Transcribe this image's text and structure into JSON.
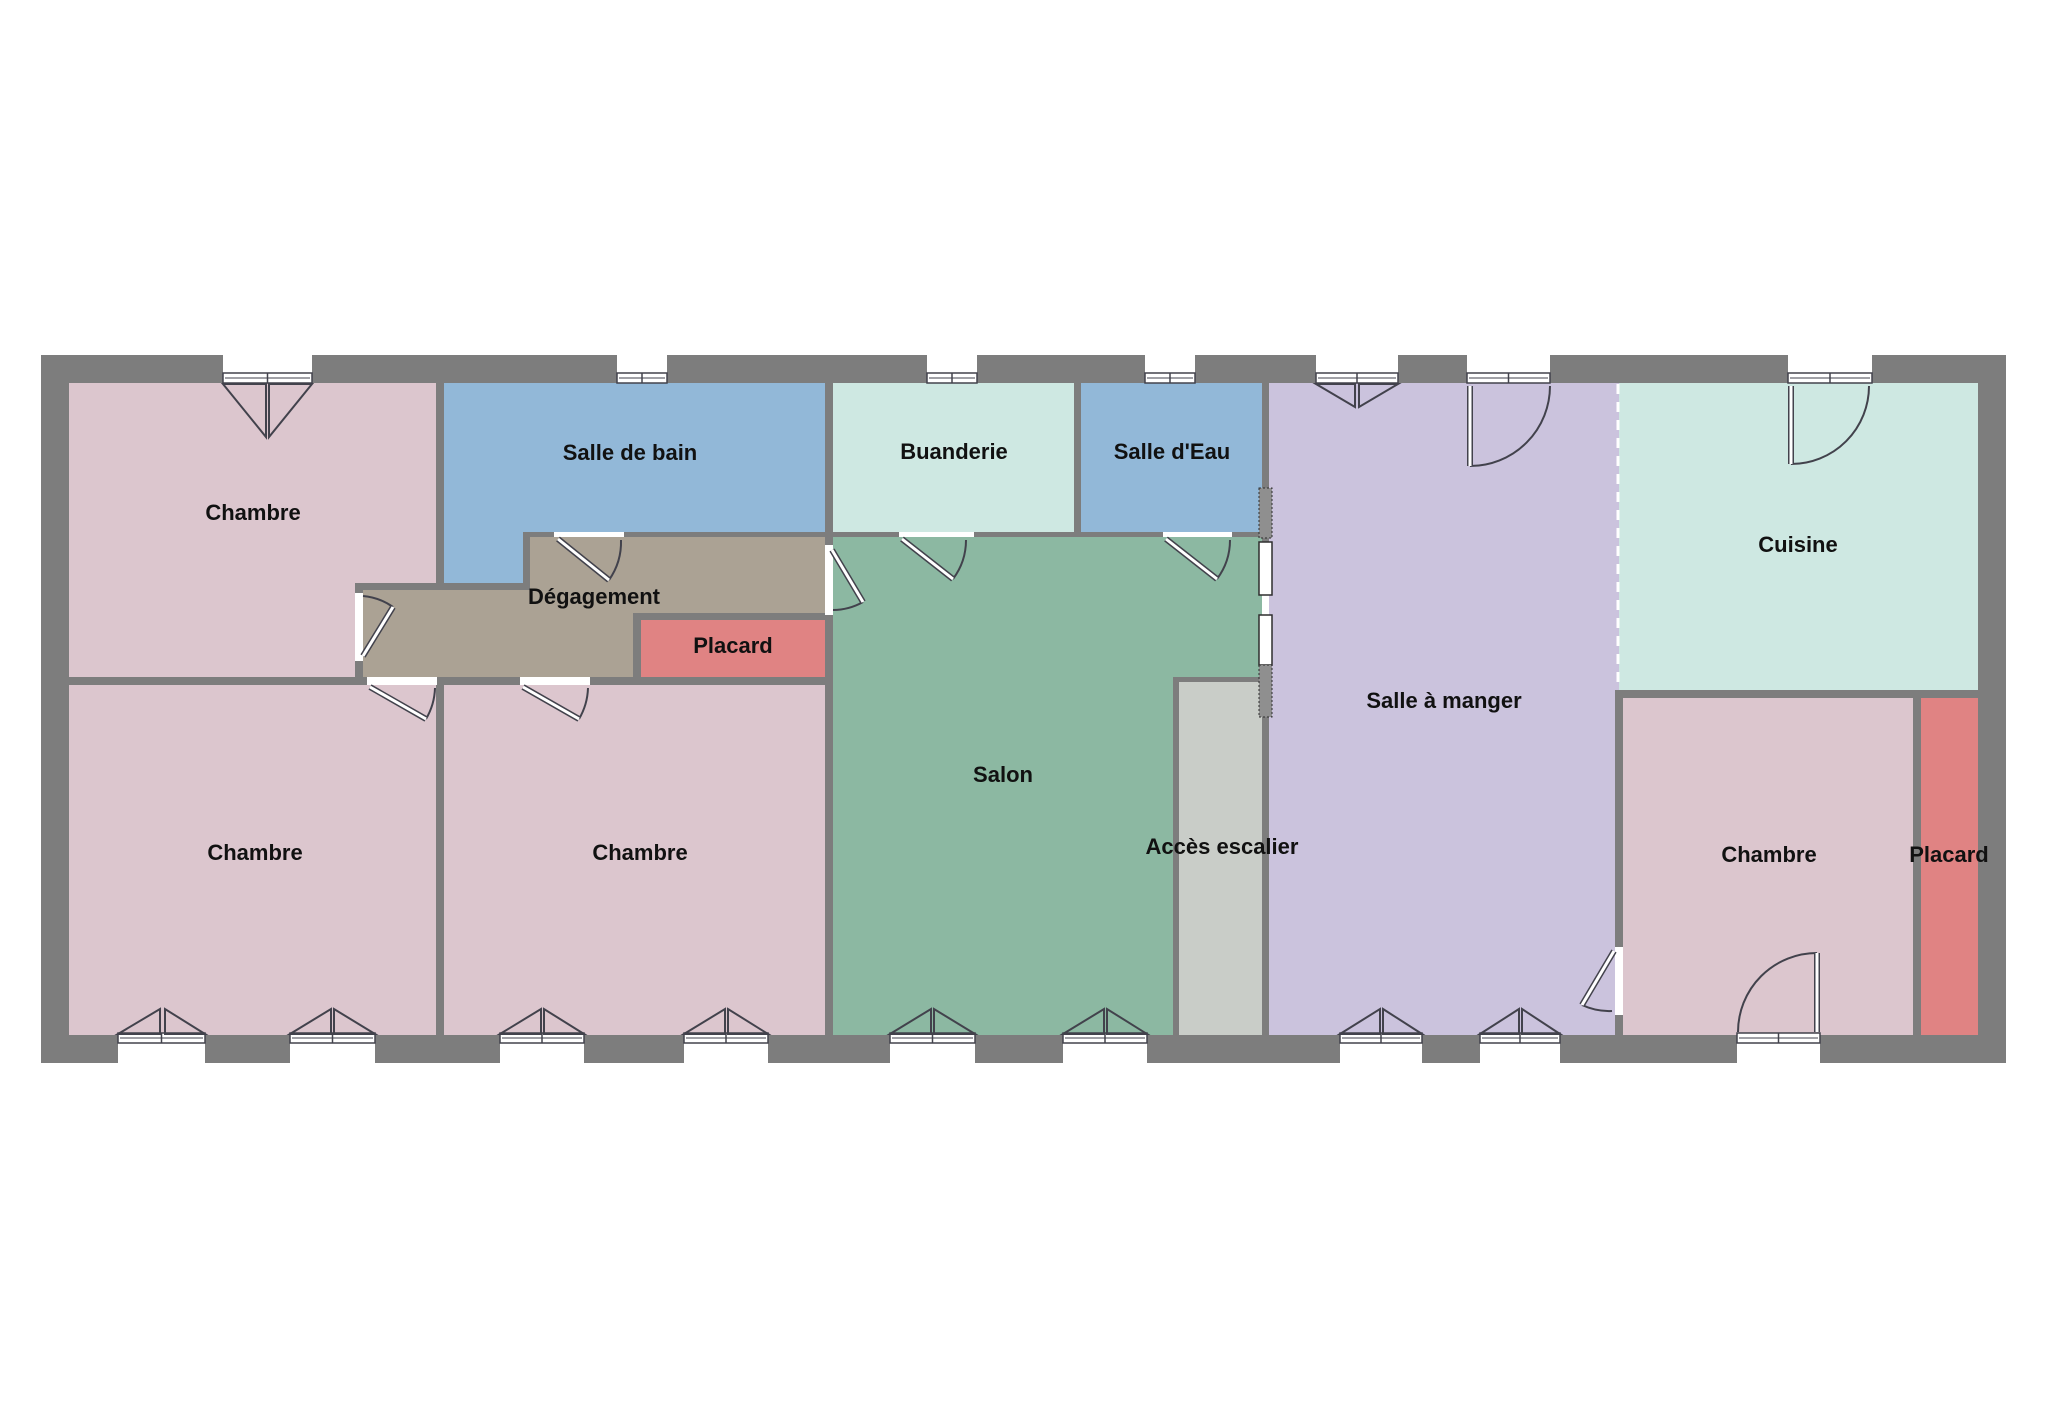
{
  "canvas": {
    "width": 2048,
    "height": 1417,
    "background": "#ffffff"
  },
  "colors": {
    "wall": "#7d7d7d",
    "line": "#42424c",
    "opening_fill": "#ffffff",
    "hatch_fill": "#8f8f8f",
    "label_color": "#111111",
    "bedroom_pink": "#dcc6ce",
    "bath_blue": "#92b8d8",
    "mint": "#cee8e2",
    "salon_green": "#8cb8a2",
    "corridor_taupe": "#aba294",
    "placard_red": "#e08383",
    "dining_purple": "#cbc3dd",
    "stair_gray": "#c9cdc8"
  },
  "shell": {
    "x": 41,
    "y": 355,
    "w": 1965,
    "h": 708
  },
  "rooms": [
    {
      "id": "chambre-tl",
      "label": "Chambre",
      "color": "#dcc6ce",
      "rects": [
        [
          69,
          383,
          367,
          200
        ],
        [
          69,
          583,
          286,
          94
        ]
      ],
      "label_pos": [
        253,
        513
      ]
    },
    {
      "id": "salle-de-bain",
      "label": "Salle de bain",
      "color": "#92b8d8",
      "rects": [
        [
          444,
          383,
          381,
          149
        ],
        [
          444,
          532,
          79,
          51
        ]
      ],
      "label_pos": [
        630,
        453
      ]
    },
    {
      "id": "buanderie",
      "label": "Buanderie",
      "color": "#cee8e2",
      "rects": [
        [
          833,
          383,
          241,
          149
        ]
      ],
      "label_pos": [
        954,
        452
      ]
    },
    {
      "id": "salle-d-eau",
      "label": "Salle d'Eau",
      "color": "#92b8d8",
      "rects": [
        [
          1081,
          383,
          181,
          149
        ]
      ],
      "label_pos": [
        1172,
        452
      ]
    },
    {
      "id": "degagement",
      "label": "Dégagement",
      "color": "#aba294",
      "rects": [
        [
          530,
          537,
          295,
          76
        ],
        [
          530,
          613,
          103,
          64
        ],
        [
          363,
          590,
          167,
          87
        ]
      ],
      "label_pos": [
        594,
        597
      ]
    },
    {
      "id": "placard-gauche",
      "label": "Placard",
      "color": "#e08383",
      "rects": [
        [
          641,
          620,
          184,
          57
        ]
      ],
      "label_pos": [
        733,
        646
      ]
    },
    {
      "id": "salon",
      "label": "Salon",
      "color": "#8cb8a2",
      "rects": [
        [
          833,
          537,
          429,
          498
        ]
      ],
      "label_pos": [
        1003,
        775
      ]
    },
    {
      "id": "salle-a-manger",
      "label": "Salle à manger",
      "color": "#cbc3dd",
      "rects": [
        [
          1269,
          383,
          350,
          652
        ]
      ],
      "label_pos": [
        1444,
        701
      ]
    },
    {
      "id": "cuisine",
      "label": "Cuisine",
      "color": "#cee8e2",
      "rects": [
        [
          1619,
          383,
          359,
          307
        ]
      ],
      "label_pos": [
        1798,
        545
      ]
    },
    {
      "id": "chambre-br",
      "label": "Chambre",
      "color": "#dcc6ce",
      "rects": [
        [
          1623,
          698,
          290,
          337
        ]
      ],
      "label_pos": [
        1769,
        855
      ]
    },
    {
      "id": "placard-droit",
      "label": "Placard",
      "color": "#e08383",
      "rects": [
        [
          1921,
          698,
          57,
          337
        ]
      ],
      "label_pos": [
        1949,
        855
      ]
    },
    {
      "id": "chambre-bl",
      "label": "Chambre",
      "color": "#dcc6ce",
      "rects": [
        [
          69,
          685,
          367,
          350
        ]
      ],
      "label_pos": [
        255,
        853
      ]
    },
    {
      "id": "chambre-milieu",
      "label": "Chambre",
      "color": "#dcc6ce",
      "rects": [
        [
          444,
          685,
          381,
          350
        ]
      ],
      "label_pos": [
        640,
        853
      ]
    },
    {
      "id": "wall-patch-escalier",
      "label": "",
      "color": "#7d7d7d",
      "rects": [
        [
          1173,
          677,
          89,
          358
        ]
      ],
      "label_pos": null
    },
    {
      "id": "wall-patch-sam-chambre",
      "label": "",
      "color": "#7d7d7d",
      "rects": [
        [
          1615,
          690,
          8,
          345
        ]
      ],
      "label_pos": null
    },
    {
      "id": "acces-escalier",
      "label": "Accès escalier",
      "color": "#c9cdc8",
      "rects": [
        [
          1179,
          682,
          83,
          353
        ]
      ],
      "label_pos": [
        1222,
        847
      ]
    }
  ],
  "openings": [
    [
      223,
      355,
      89,
      28
    ],
    [
      617,
      355,
      50,
      28
    ],
    [
      927,
      355,
      50,
      28
    ],
    [
      1145,
      355,
      50,
      28
    ],
    [
      1316,
      355,
      82,
      28
    ],
    [
      1467,
      355,
      83,
      28
    ],
    [
      1788,
      355,
      84,
      28
    ],
    [
      118,
      1035,
      87,
      28
    ],
    [
      290,
      1035,
      85,
      28
    ],
    [
      500,
      1035,
      84,
      28
    ],
    [
      684,
      1035,
      84,
      28
    ],
    [
      890,
      1035,
      85,
      28
    ],
    [
      1063,
      1035,
      84,
      28
    ],
    [
      1340,
      1035,
      82,
      28
    ],
    [
      1480,
      1035,
      80,
      28
    ],
    [
      1737,
      1035,
      83,
      28
    ],
    [
      355,
      593,
      8,
      68
    ],
    [
      554,
      532,
      70,
      5
    ],
    [
      825,
      545,
      8,
      70
    ],
    [
      899,
      532,
      75,
      5
    ],
    [
      1163,
      532,
      69,
      5
    ],
    [
      1615,
      947,
      8,
      68
    ],
    [
      367,
      677,
      70,
      8
    ],
    [
      520,
      677,
      70,
      8
    ],
    [
      1262,
      595,
      7,
      20
    ]
  ],
  "window_frames": [
    [
      223,
      373,
      89,
      10
    ],
    [
      617,
      373,
      50,
      10
    ],
    [
      927,
      373,
      50,
      10
    ],
    [
      1145,
      373,
      50,
      10
    ],
    [
      1316,
      373,
      82,
      10
    ],
    [
      1467,
      373,
      83,
      10
    ],
    [
      1788,
      373,
      84,
      10
    ],
    [
      118,
      1033,
      87,
      10
    ],
    [
      290,
      1033,
      85,
      10
    ],
    [
      500,
      1033,
      84,
      10
    ],
    [
      684,
      1033,
      84,
      10
    ],
    [
      890,
      1033,
      85,
      10
    ],
    [
      1063,
      1033,
      84,
      10
    ],
    [
      1340,
      1033,
      82,
      10
    ],
    [
      1480,
      1033,
      80,
      10
    ],
    [
      1737,
      1033,
      83,
      10
    ]
  ],
  "casement_triangles": [
    [
      [
        223,
        384
      ],
      [
        266,
        437
      ],
      [
        266,
        384
      ]
    ],
    [
      [
        312,
        384
      ],
      [
        269,
        437
      ],
      [
        269,
        384
      ]
    ],
    [
      [
        1316,
        384
      ],
      [
        1355,
        407
      ],
      [
        1355,
        384
      ]
    ],
    [
      [
        1398,
        384
      ],
      [
        1359,
        407
      ],
      [
        1359,
        384
      ]
    ],
    [
      [
        118,
        1034
      ],
      [
        160,
        1009
      ],
      [
        160,
        1034
      ]
    ],
    [
      [
        205,
        1034
      ],
      [
        165,
        1009
      ],
      [
        165,
        1034
      ]
    ],
    [
      [
        290,
        1034
      ],
      [
        331,
        1009
      ],
      [
        331,
        1034
      ]
    ],
    [
      [
        375,
        1034
      ],
      [
        334,
        1009
      ],
      [
        334,
        1034
      ]
    ],
    [
      [
        500,
        1034
      ],
      [
        541,
        1009
      ],
      [
        541,
        1034
      ]
    ],
    [
      [
        584,
        1034
      ],
      [
        544,
        1009
      ],
      [
        544,
        1034
      ]
    ],
    [
      [
        684,
        1034
      ],
      [
        725,
        1009
      ],
      [
        725,
        1034
      ]
    ],
    [
      [
        768,
        1034
      ],
      [
        728,
        1009
      ],
      [
        728,
        1034
      ]
    ],
    [
      [
        890,
        1034
      ],
      [
        931,
        1009
      ],
      [
        931,
        1034
      ]
    ],
    [
      [
        975,
        1034
      ],
      [
        934,
        1009
      ],
      [
        934,
        1034
      ]
    ],
    [
      [
        1063,
        1034
      ],
      [
        1104,
        1009
      ],
      [
        1104,
        1034
      ]
    ],
    [
      [
        1147,
        1034
      ],
      [
        1107,
        1009
      ],
      [
        1107,
        1034
      ]
    ],
    [
      [
        1340,
        1034
      ],
      [
        1380,
        1009
      ],
      [
        1380,
        1034
      ]
    ],
    [
      [
        1422,
        1034
      ],
      [
        1383,
        1009
      ],
      [
        1383,
        1034
      ]
    ],
    [
      [
        1480,
        1034
      ],
      [
        1519,
        1009
      ],
      [
        1519,
        1034
      ]
    ],
    [
      [
        1560,
        1034
      ],
      [
        1522,
        1009
      ],
      [
        1522,
        1034
      ]
    ]
  ],
  "doors": [
    {
      "id": "porte-salle-a-manger-haut",
      "leaf": [
        1470,
        386,
        1470,
        466
      ],
      "arc": "M 1470 466 A 80 80 0 0 0 1550 386"
    },
    {
      "id": "porte-cuisine-haut",
      "leaf": [
        1791,
        386,
        1791,
        464
      ],
      "arc": "M 1791 464 A 78 78 0 0 0 1869 386"
    },
    {
      "id": "porte-chambre-br-ext",
      "leaf": [
        1817,
        953,
        1817,
        1032
      ],
      "arc": "M 1817 953 A 79 79 0 0 0 1738 1032"
    },
    {
      "id": "porte-chambre-tl-degagement",
      "leaf": [
        363,
        656,
        393,
        607
      ],
      "arc": "M 363 596 A 61 61 0 0 1 393 607"
    },
    {
      "id": "porte-salle-de-bain",
      "leaf": [
        558,
        539,
        609,
        580
      ],
      "arc": "M 609 580 A 66 66 0 0 0 621 540"
    },
    {
      "id": "porte-degagement-salon",
      "leaf": [
        832,
        550,
        863,
        602
      ],
      "arc": "M 863 602 A 62 62 0 0 1 833 610"
    },
    {
      "id": "porte-buanderie-salon",
      "leaf": [
        902,
        539,
        953,
        579
      ],
      "arc": "M 953 579 A 65 65 0 0 0 966 540"
    },
    {
      "id": "porte-salle-d-eau-salon",
      "leaf": [
        1166,
        539,
        1217,
        579
      ],
      "arc": "M 1217 579 A 65 65 0 0 0 1230 540"
    },
    {
      "id": "porte-sam-chambre-br",
      "leaf": [
        1614,
        951,
        1582,
        1005
      ],
      "arc": "M 1582 1005 A 64 64 0 0 0 1612 1011"
    },
    {
      "id": "porte-chambre-bl",
      "leaf": [
        370,
        687,
        426,
        719
      ],
      "arc": "M 426 719 A 65 65 0 0 0 435 688"
    },
    {
      "id": "porte-chambre-milieu",
      "leaf": [
        523,
        687,
        579,
        719
      ],
      "arc": "M 579 719 A 65 65 0 0 0 588 688"
    }
  ],
  "partition_panels": [
    {
      "rect": [
        1259,
        488,
        13,
        50
      ],
      "style": "hatched"
    },
    {
      "rect": [
        1259,
        542,
        13,
        53
      ],
      "style": "solid"
    },
    {
      "rect": [
        1259,
        615,
        13,
        50
      ],
      "style": "solid"
    },
    {
      "rect": [
        1259,
        665,
        13,
        52
      ],
      "style": "hatched"
    }
  ],
  "open_boundary_dashed": {
    "x": 1618,
    "y1": 384,
    "y2": 690
  }
}
